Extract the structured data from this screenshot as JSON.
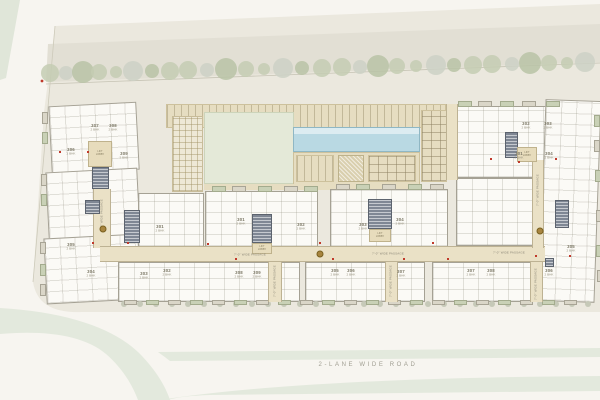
{
  "plan": {
    "road_label": "2-LANE  WIDE  ROAD",
    "passage_label": "7'-0\" WIDE PASSAGE",
    "lobby_label_line1": "LIFT",
    "lobby_label_line2": "LOBBY",
    "unit_type": "2 BHK"
  },
  "colors": {
    "background": "#f7f5f0",
    "site": "#ebe8de",
    "road_band": "#e2dfd4",
    "green_strip": "#e3e9dd",
    "tree_green": "#c4ccb3",
    "tree_green_dark": "#b9c3a6",
    "tree_gray": "#ccd1c5",
    "shrub": "#c6c9b8",
    "shrub_dark": "#b8bda9",
    "building": "#fbfaf6",
    "wall": "#a5a194",
    "corridor": "#eae1c6",
    "lobby": "#e7dcbc",
    "core": "#7f8794",
    "lawn": "#e4e9d8",
    "pool": "#b9d9e3",
    "accent_red": "#c0392b",
    "accent_gold": "#a8853f",
    "label_text": "#7c7866",
    "road_text": "#a09e92"
  },
  "units": [
    {
      "no": "307",
      "x": 95,
      "y": 128
    },
    {
      "no": "308",
      "x": 113,
      "y": 128
    },
    {
      "no": "306",
      "x": 71,
      "y": 152
    },
    {
      "no": "309",
      "x": 124,
      "y": 156
    },
    {
      "no": "301",
      "x": 160,
      "y": 229
    },
    {
      "no": "305",
      "x": 71,
      "y": 247
    },
    {
      "no": "304",
      "x": 91,
      "y": 274
    },
    {
      "no": "303",
      "x": 144,
      "y": 276
    },
    {
      "no": "302",
      "x": 167,
      "y": 273
    },
    {
      "no": "301",
      "x": 241,
      "y": 222
    },
    {
      "no": "302",
      "x": 301,
      "y": 227
    },
    {
      "no": "308",
      "x": 239,
      "y": 275
    },
    {
      "no": "309",
      "x": 257,
      "y": 275
    },
    {
      "no": "303",
      "x": 363,
      "y": 227
    },
    {
      "no": "304",
      "x": 400,
      "y": 222
    },
    {
      "no": "305",
      "x": 335,
      "y": 273
    },
    {
      "no": "306",
      "x": 351,
      "y": 273
    },
    {
      "no": "307",
      "x": 401,
      "y": 274
    },
    {
      "no": "302",
      "x": 526,
      "y": 126
    },
    {
      "no": "303",
      "x": 548,
      "y": 126
    },
    {
      "no": "301",
      "x": 519,
      "y": 156
    },
    {
      "no": "304",
      "x": 549,
      "y": 156
    },
    {
      "no": "305",
      "x": 571,
      "y": 249
    },
    {
      "no": "306",
      "x": 549,
      "y": 273
    },
    {
      "no": "307",
      "x": 471,
      "y": 273
    },
    {
      "no": "308",
      "x": 491,
      "y": 273
    }
  ],
  "passages": {
    "horizontal": [
      {
        "x": 250,
        "y": 255
      },
      {
        "x": 388,
        "y": 254
      },
      {
        "x": 509,
        "y": 253
      }
    ],
    "vertical": [
      {
        "x": 102,
        "y": 215
      },
      {
        "x": 275,
        "y": 281
      },
      {
        "x": 391,
        "y": 281
      },
      {
        "x": 536,
        "y": 284
      },
      {
        "x": 538,
        "y": 190
      }
    ]
  },
  "lobbies": [
    {
      "x": 100,
      "y": 153
    },
    {
      "x": 262,
      "y": 248
    },
    {
      "x": 380,
      "y": 235
    },
    {
      "x": 527,
      "y": 154
    }
  ],
  "markers": {
    "gold": [
      {
        "x": 103,
        "y": 229
      },
      {
        "x": 320,
        "y": 254
      },
      {
        "x": 540,
        "y": 231
      }
    ],
    "red": [
      {
        "x": 60,
        "y": 152
      },
      {
        "x": 88,
        "y": 152
      },
      {
        "x": 93,
        "y": 243
      },
      {
        "x": 128,
        "y": 243
      },
      {
        "x": 208,
        "y": 244
      },
      {
        "x": 236,
        "y": 259
      },
      {
        "x": 320,
        "y": 243
      },
      {
        "x": 333,
        "y": 259
      },
      {
        "x": 404,
        "y": 259
      },
      {
        "x": 433,
        "y": 243
      },
      {
        "x": 448,
        "y": 259
      },
      {
        "x": 491,
        "y": 159
      },
      {
        "x": 519,
        "y": 162
      },
      {
        "x": 556,
        "y": 159
      },
      {
        "x": 536,
        "y": 256
      },
      {
        "x": 570,
        "y": 256
      }
    ]
  }
}
